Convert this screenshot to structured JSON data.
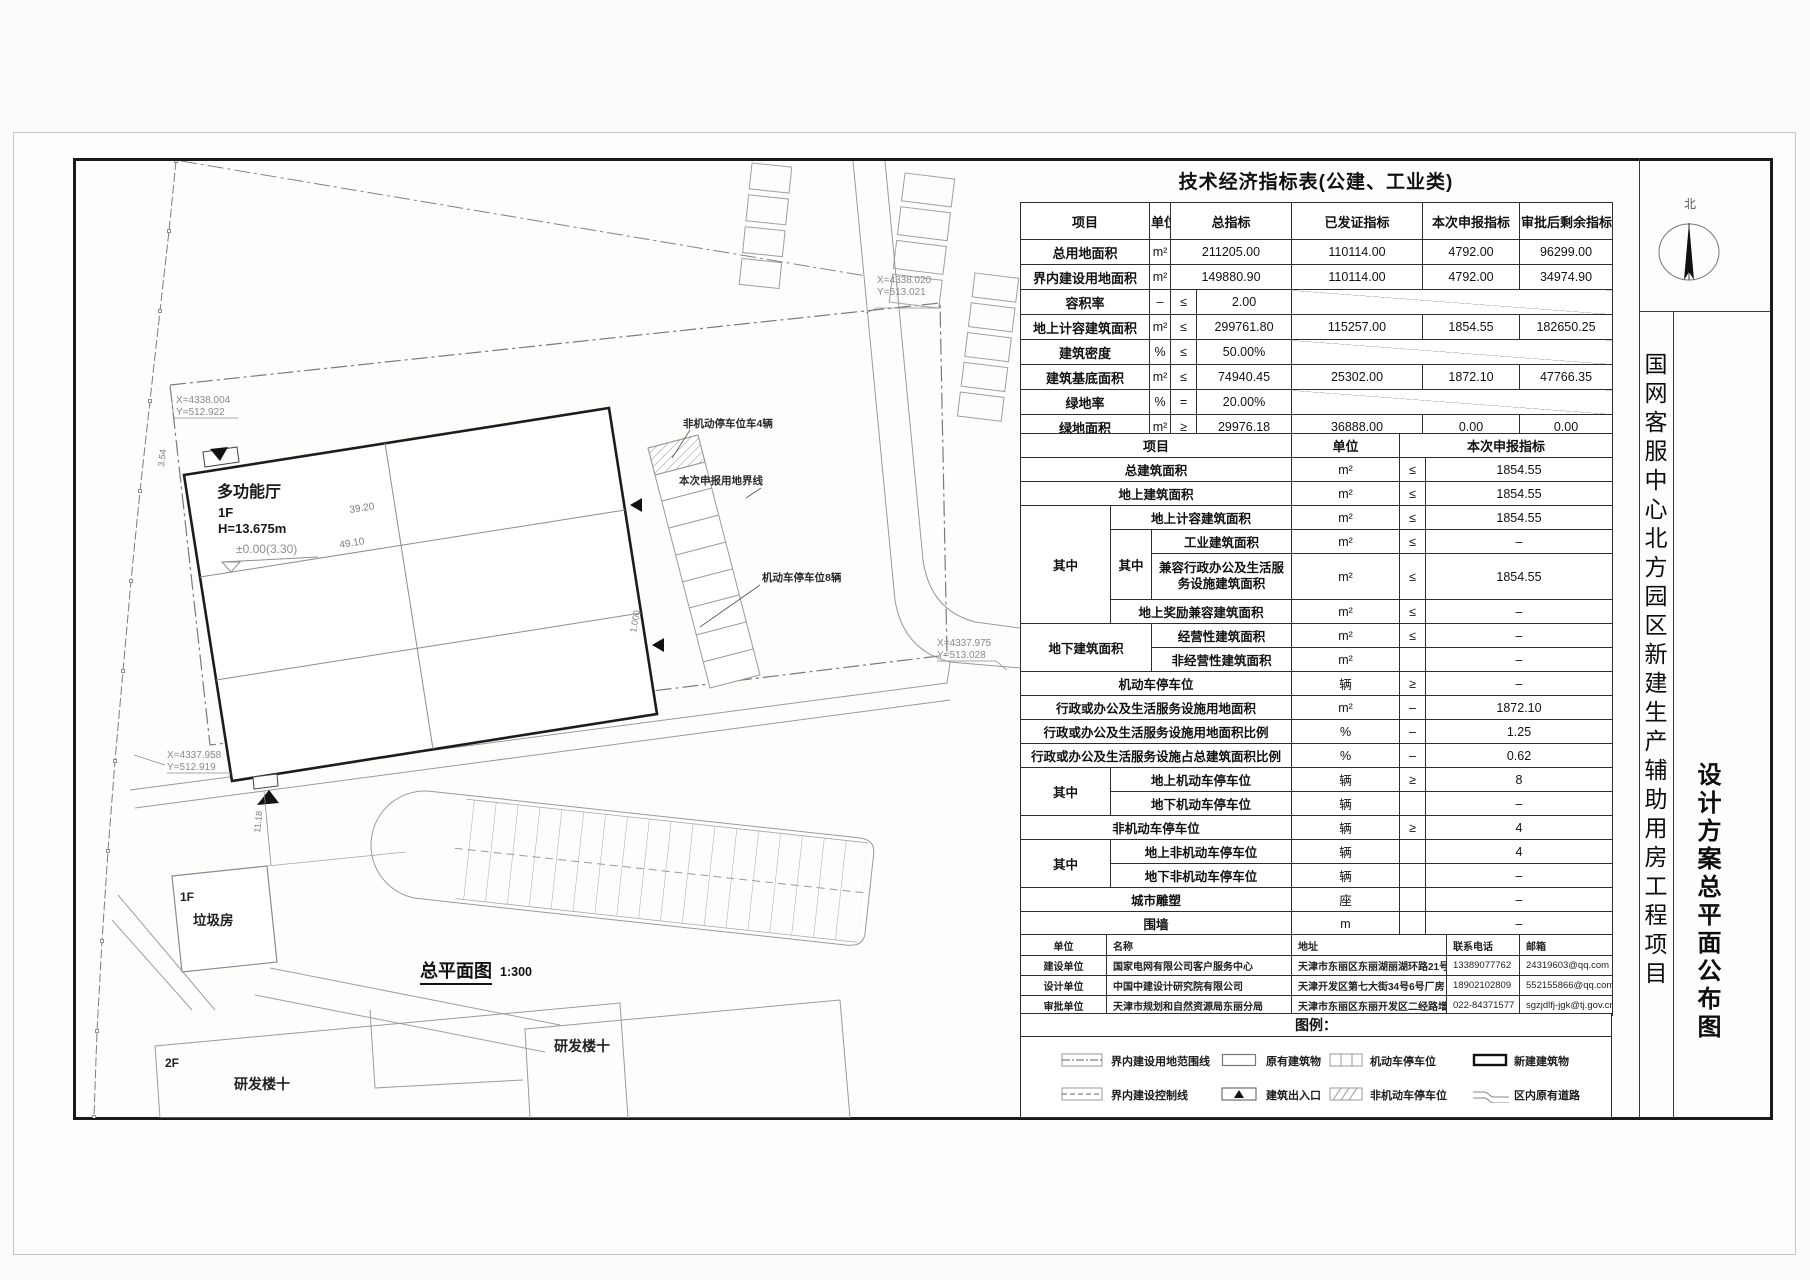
{
  "drawing": {
    "table1_title": "技术经济指标表(公建、工业类)",
    "project_title": "国网客服中心北方园区新建生产辅助用房工程项目",
    "sheet_title": "设计方案总平面公布图",
    "north_label": "北",
    "legend_title": "图例："
  },
  "table1": {
    "headers": {
      "item": "项目",
      "unit": "单位",
      "total": "总指标",
      "issued": "已发证指标",
      "declared": "本次申报指标",
      "remaining": "审批后剩余指标"
    },
    "rows": [
      {
        "label": "总用地面积",
        "unit": "m²",
        "op": "",
        "total": "211205.00",
        "issued": "110114.00",
        "declared": "4792.00",
        "remaining": "96299.00"
      },
      {
        "label": "界内建设用地面积",
        "unit": "m²",
        "op": "",
        "total": "149880.90",
        "issued": "110114.00",
        "declared": "4792.00",
        "remaining": "34974.90"
      },
      {
        "label": "容积率",
        "unit": "–",
        "op": "≤",
        "total": "2.00",
        "issued": "",
        "declared": "",
        "remaining": ""
      },
      {
        "label": "地上计容建筑面积",
        "unit": "m²",
        "op": "≤",
        "total": "299761.80",
        "issued": "115257.00",
        "declared": "1854.55",
        "remaining": "182650.25"
      },
      {
        "label": "建筑密度",
        "unit": "%",
        "op": "≤",
        "total": "50.00%",
        "issued": "",
        "declared": "",
        "remaining": ""
      },
      {
        "label": "建筑基底面积",
        "unit": "m²",
        "op": "≤",
        "total": "74940.45",
        "issued": "25302.00",
        "declared": "1872.10",
        "remaining": "47766.35"
      },
      {
        "label": "绿地率",
        "unit": "%",
        "op": "=",
        "total": "20.00%",
        "issued": "",
        "declared": "",
        "remaining": ""
      },
      {
        "label": "绿地面积",
        "unit": "m²",
        "op": "≥",
        "total": "29976.18",
        "issued": "36888.00",
        "declared": "0.00",
        "remaining": "0.00"
      }
    ]
  },
  "table2": {
    "headers": {
      "item": "项目",
      "unit": "单位",
      "declared": "本次申报指标"
    },
    "groups": {
      "g1": "其中",
      "g2": "其中",
      "g3": "地下建筑面积",
      "g4": "其中",
      "g5": "其中"
    },
    "rows": [
      {
        "label": "总建筑面积",
        "unit": "m²",
        "op": "≤",
        "value": "1854.55"
      },
      {
        "label": "地上建筑面积",
        "unit": "m²",
        "op": "≤",
        "value": "1854.55"
      },
      {
        "label": "地上计容建筑面积",
        "unit": "m²",
        "op": "≤",
        "value": "1854.55"
      },
      {
        "label": "工业建筑面积",
        "unit": "m²",
        "op": "≤",
        "value": "–"
      },
      {
        "label": "兼容行政办公及生活服务设施建筑面积",
        "unit": "m²",
        "op": "≤",
        "value": "1854.55"
      },
      {
        "label": "地上奖励兼容建筑面积",
        "unit": "m²",
        "op": "≤",
        "value": "–"
      },
      {
        "label": "经营性建筑面积",
        "unit": "m²",
        "op": "≤",
        "value": "–"
      },
      {
        "label": "非经营性建筑面积",
        "unit": "m²",
        "op": "",
        "value": "–"
      },
      {
        "label": "机动车停车位",
        "unit": "辆",
        "op": "≥",
        "value": "–"
      },
      {
        "label": "行政或办公及生活服务设施用地面积",
        "unit": "m²",
        "op": "–",
        "value": "1872.10"
      },
      {
        "label": "行政或办公及生活服务设施用地面积比例",
        "unit": "%",
        "op": "–",
        "value": "1.25"
      },
      {
        "label": "行政或办公及生活服务设施占总建筑面积比例",
        "unit": "%",
        "op": "–",
        "value": "0.62"
      },
      {
        "label": "地上机动车停车位",
        "unit": "辆",
        "op": "≥",
        "value": "8"
      },
      {
        "label": "地下机动车停车位",
        "unit": "辆",
        "op": "",
        "value": "–"
      },
      {
        "label": "非机动车停车位",
        "unit": "辆",
        "op": "≥",
        "value": "4"
      },
      {
        "label": "地上非机动车停车位",
        "unit": "辆",
        "op": "",
        "value": "4"
      },
      {
        "label": "地下非机动车停车位",
        "unit": "辆",
        "op": "",
        "value": "–"
      },
      {
        "label": "城市雕塑",
        "unit": "座",
        "op": "",
        "value": "–"
      },
      {
        "label": "围墙",
        "unit": "m",
        "op": "",
        "value": "–"
      }
    ]
  },
  "info_table": {
    "headers": [
      "单位",
      "名称",
      "地址",
      "联系电话",
      "邮箱"
    ],
    "rows": [
      {
        "role": "建设单位",
        "name": "国家电网有限公司客户服务中心",
        "address": "天津市东丽区东丽湖丽湖环路21号",
        "phone": "13389077762",
        "email": "24319603@qq.com"
      },
      {
        "role": "设计单位",
        "name": "中国中建设计研究院有限公司",
        "address": "天津开发区第七大街34号6号厂房",
        "phone": "18902102809",
        "email": "552155866@qq.com"
      },
      {
        "role": "审批单位",
        "name": "天津市规划和自然资源局东丽分局",
        "address": "天津市东丽区东丽开发区二经路增2号",
        "phone": "022-84371577",
        "email": "sgzjdlfj-jgk@tj.gov.cn"
      }
    ]
  },
  "legend": {
    "items": [
      {
        "label": "界内建设用地范围线"
      },
      {
        "label": "原有建筑物"
      },
      {
        "label": "机动车停车位"
      },
      {
        "label": "新建建筑物"
      },
      {
        "label": "界内建设控制线"
      },
      {
        "label": "建筑出入口"
      },
      {
        "label": "非机动车停车位"
      },
      {
        "label": "区内原有道路"
      }
    ]
  },
  "plan": {
    "title": "总平面图",
    "scale": "1:300",
    "boundary_label": "本次申报用地界线",
    "building": {
      "name": "多功能厅",
      "floors": "1F",
      "height": "H=13.675m",
      "level": "±0.00(3.30)"
    },
    "trash": {
      "floors": "1F",
      "name": "垃圾房"
    },
    "rd_left": {
      "floors": "2F",
      "name": "研发楼十"
    },
    "rd_right": {
      "name": "研发楼十"
    },
    "parking_moto_label": "机动车停车位8辆",
    "parking_bike_label": "非机动停车位车4辆",
    "coords": {
      "c1x": "X=4338.004",
      "c1y": "Y=512.922",
      "c2x": "X=4338.020",
      "c2y": "Y=513.021",
      "c3x": "X=4337.975",
      "c3y": "Y=513.028",
      "c4x": "X=4337.958",
      "c4y": "Y=512.919"
    },
    "dims": {
      "d1": "39.20",
      "d2": "49.10",
      "d3": "11.18",
      "d4": "3.54",
      "d5": "1.000"
    }
  }
}
